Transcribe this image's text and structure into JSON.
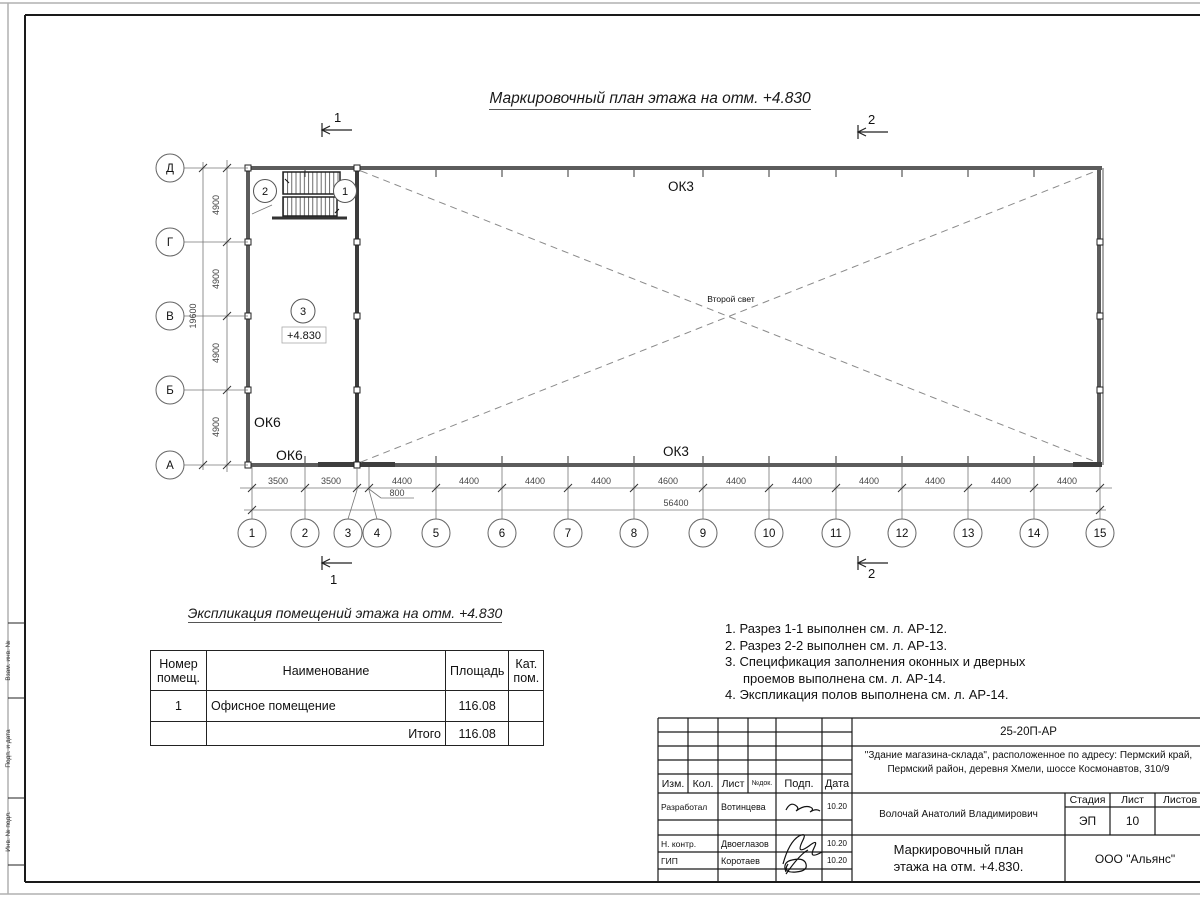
{
  "sheet": {
    "main_title": "Маркировочный план этажа на отм. +4.830",
    "side_labels": [
      "Взам. инв. №",
      "Подп. и дата",
      "Инв. № подл."
    ]
  },
  "plan": {
    "row_axes": [
      "Д",
      "Г",
      "В",
      "Б",
      "А"
    ],
    "column_axes": [
      "1",
      "2",
      "3",
      "4",
      "5",
      "6",
      "7",
      "8",
      "9",
      "10",
      "11",
      "12",
      "13",
      "14",
      "15"
    ],
    "dims_h": [
      "3500",
      "3500",
      "4400",
      "4400",
      "4400",
      "4400",
      "4600",
      "4400",
      "4400",
      "4400",
      "4400",
      "4400",
      "4400"
    ],
    "dim_small": "800",
    "total_h": "56400",
    "dims_v": [
      "4900",
      "4900",
      "4900",
      "4900"
    ],
    "total_v": "19600",
    "room_tag": "3",
    "elevation_label": "+4.830",
    "void_label": "Второй свет",
    "ok3_top": "ОК3",
    "ok3_bottom": "ОК3",
    "ok6_upper": "ОК6",
    "ok6_lower": "ОК6",
    "stair_tag_left": "2",
    "stair_tag_right": "1",
    "section_top_1": "1",
    "section_top_2": "2",
    "section_bottom_1": "1",
    "section_bottom_2": "2"
  },
  "explication": {
    "title": "Экспликация помещений этажа на отм. +4.830",
    "headers": [
      "Номер помещ.",
      "Наименование",
      "Площадь",
      "Кат. пом."
    ],
    "rows": [
      [
        "1",
        "Офисное помещение",
        "116.08",
        ""
      ],
      [
        "",
        "Итого",
        "116.08",
        ""
      ]
    ]
  },
  "notes": {
    "lines": [
      "1. Разрез 1-1 выполнен см. л. АР-12.",
      "2. Разрез 2-2 выполнен см. л. АР-13.",
      "3. Спецификация заполнения оконных и дверных проемов выполнена см. л. АР-14.",
      "4. Экспликация полов выполнена см. л. АР-14."
    ]
  },
  "titleblock": {
    "doc_number": "25-20П-АР",
    "project_line1": "\"Здание магазина-склада\", расположенное по адресу: Пермский край,",
    "project_line2": "Пермский район, деревня Хмели, шоссе Космонавтов, 310/9",
    "rev_headers": [
      "Изм.",
      "Кол.",
      "Лист",
      "№док.",
      "Подп.",
      "Дата"
    ],
    "role1_label": "Разработал",
    "role1_name": "Вотинцева",
    "role1_date": "10.20",
    "role2_label": "Н. контр.",
    "role2_name": "Двоеглазов",
    "role2_date": "10.20",
    "role3_label": "ГИП",
    "role3_name": "Коротаев",
    "role3_date": "10.20",
    "chief": "Волочай Анатолий Владимирович",
    "stage_header": [
      "Стадия",
      "Лист",
      "Листов"
    ],
    "stage_value": "ЭП",
    "sheet_value": "10",
    "sheets_value": "",
    "drawing_title_line1": "Маркировочный план",
    "drawing_title_line2": "этажа на отм. +4.830.",
    "company": "ООО \"Альянс\""
  }
}
